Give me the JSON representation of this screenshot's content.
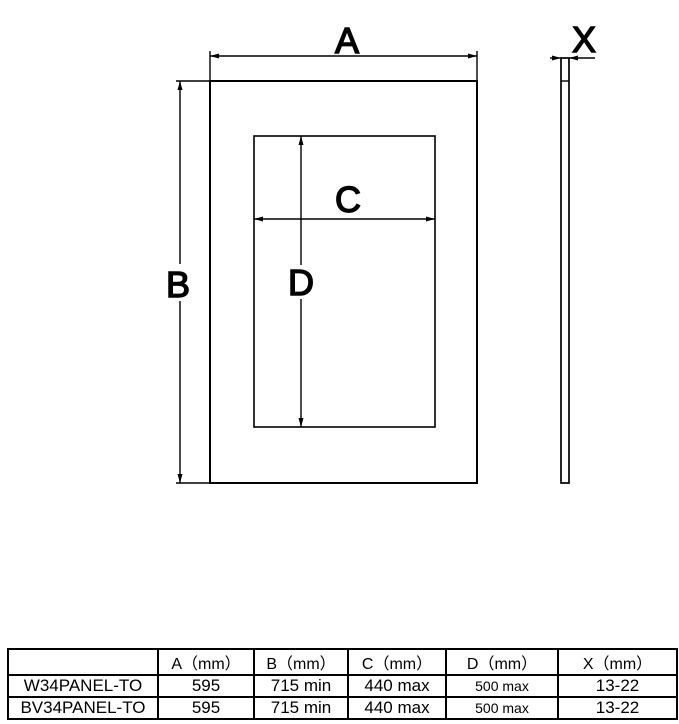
{
  "diagram": {
    "labels": {
      "panel_width": "A",
      "panel_height": "B",
      "cutout_width": "C",
      "cutout_height": "D",
      "thickness": "X"
    }
  },
  "table": {
    "headers": [
      "",
      "A（mm）",
      "B（mm）",
      "C（mm）",
      "D（mm）",
      "X（mm）"
    ],
    "rows": [
      [
        "W34PANEL-TO",
        "595",
        "715 min",
        "440 max",
        "500 max",
        "13-22"
      ],
      [
        "BV34PANEL-TO",
        "595",
        "715 min",
        "440 max",
        "500 max",
        "13-22"
      ]
    ]
  }
}
